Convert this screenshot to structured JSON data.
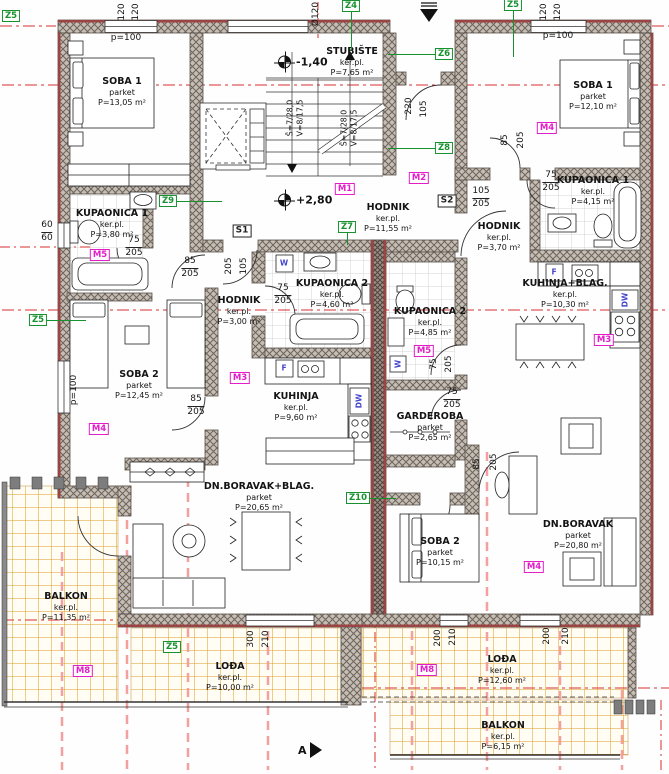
{
  "drawing": {
    "type": "architectural-floor-plan",
    "colors": {
      "wall_red": "#9c4343",
      "axis_red": "#d93030",
      "axis_pink": "#f2a0a0",
      "tag_green": "#17922f",
      "tag_magenta": "#e31ec8",
      "tile_orange": "#dc9a25",
      "appliance_blue": "#4646cc"
    }
  },
  "rooms": [
    {
      "id": "soba1-left",
      "name": "SOBA 1",
      "floor": "parket",
      "area": "P=13,05 m²",
      "x": 122,
      "y": 76
    },
    {
      "id": "kupaonica1-left",
      "name": "KUPAONICA 1",
      "floor": "ker.pl.",
      "area": "P=3,80 m²",
      "x": 112,
      "y": 208
    },
    {
      "id": "soba2-left",
      "name": "SOBA 2",
      "floor": "parket",
      "area": "P=12,45 m²",
      "x": 139,
      "y": 369
    },
    {
      "id": "hodnik-left",
      "name": "HODNIK",
      "floor": "ker.pl.",
      "area": "P=3,00 m²",
      "x": 239,
      "y": 295
    },
    {
      "id": "kupaonica2-left",
      "name": "KUPAONICA 2",
      "floor": "ker.pl.",
      "area": "P=4,60 m²",
      "x": 332,
      "y": 278
    },
    {
      "id": "kuhinja-left",
      "name": "KUHINJA",
      "floor": "ker.pl.",
      "area": "P=9,60 m²",
      "x": 296,
      "y": 391
    },
    {
      "id": "dnevni-left",
      "name": "DN.BORAVAK+BLAG.",
      "floor": "parket",
      "area": "P=20,65 m²",
      "x": 259,
      "y": 481
    },
    {
      "id": "balkon-left",
      "name": "BALKON",
      "floor": "ker.pl.",
      "area": "P=11,35 m²",
      "x": 66,
      "y": 591
    },
    {
      "id": "loda-left",
      "name": "LOĐA",
      "floor": "ker.pl.",
      "area": "P=10,00 m²",
      "x": 230,
      "y": 661
    },
    {
      "id": "stubiste",
      "name": "STUBIŠTE",
      "floor": "ker.pl.",
      "area": "P=7,65 m²",
      "x": 352,
      "y": 46
    },
    {
      "id": "hodnik-zajednicki",
      "name": "HODNIK",
      "floor": "ker.pl.",
      "area": "P=11,55 m²",
      "x": 388,
      "y": 202
    },
    {
      "id": "soba1-right",
      "name": "SOBA 1",
      "floor": "parket",
      "area": "P=12,10 m²",
      "x": 593,
      "y": 80
    },
    {
      "id": "kupaonica1-right",
      "name": "KUPAONICA 1",
      "floor": "ker.pl.",
      "area": "P=4,15 m²",
      "x": 593,
      "y": 175
    },
    {
      "id": "hodnik-right",
      "name": "HODNIK",
      "floor": "ker.pl.",
      "area": "P=3,70 m²",
      "x": 499,
      "y": 221
    },
    {
      "id": "kuhinja-blag-right",
      "name": "KUHINJA+BLAG.",
      "floor": "ker.pl.",
      "area": "P=10,30 m²",
      "x": 565,
      "y": 278
    },
    {
      "id": "kupaonica2-right",
      "name": "KUPAONICA 2",
      "floor": "ker.pl.",
      "area": "P=4,85 m²",
      "x": 430,
      "y": 306
    },
    {
      "id": "garderoba-right",
      "name": "GARDEROBA",
      "floor": "parket",
      "area": "P=2,65 m²",
      "x": 430,
      "y": 411
    },
    {
      "id": "soba2-right",
      "name": "SOBA 2",
      "floor": "parket",
      "area": "P=10,15 m²",
      "x": 440,
      "y": 536
    },
    {
      "id": "dnevni-right",
      "name": "DN.BORAVAK",
      "floor": "parket",
      "area": "P=20,80 m²",
      "x": 578,
      "y": 519
    },
    {
      "id": "loda-right",
      "name": "LOĐA",
      "floor": "ker.pl.",
      "area": "P=12,60 m²",
      "x": 502,
      "y": 654
    },
    {
      "id": "balkon-right",
      "name": "BALKON",
      "floor": "ker.pl.",
      "area": "P=6,15 m²",
      "x": 503,
      "y": 720
    }
  ],
  "green_tags": [
    {
      "label": "Z5",
      "x": 11,
      "y": 16,
      "lx": 0,
      "ly": 0
    },
    {
      "label": "Z4",
      "x": 351,
      "y": 6,
      "lx": 0,
      "ly": 38
    },
    {
      "label": "Z5",
      "x": 513,
      "y": 5,
      "lx": 0,
      "ly": 46
    },
    {
      "label": "Z6",
      "x": 444,
      "y": 54,
      "lx": -48,
      "ly": 0
    },
    {
      "label": "Z8",
      "x": 444,
      "y": 148,
      "lx": -48,
      "ly": 0
    },
    {
      "label": "Z9",
      "x": 168,
      "y": 201,
      "lx": 46,
      "ly": 0
    },
    {
      "label": "Z7",
      "x": 347,
      "y": 227,
      "lx": 0,
      "ly": 12
    },
    {
      "label": "Z5",
      "x": 38,
      "y": 320,
      "lx": 40,
      "ly": 0
    },
    {
      "label": "Z10",
      "x": 358,
      "y": 498,
      "lx": 30,
      "ly": 0
    },
    {
      "label": "Z5",
      "x": 172,
      "y": 647,
      "lx": 0,
      "ly": 0
    }
  ],
  "magenta_tags": [
    {
      "label": "M5",
      "x": 100,
      "y": 255
    },
    {
      "label": "M1",
      "x": 345,
      "y": 189
    },
    {
      "label": "M2",
      "x": 419,
      "y": 178
    },
    {
      "label": "M4",
      "x": 547,
      "y": 128
    },
    {
      "label": "M3",
      "x": 240,
      "y": 378
    },
    {
      "label": "M5",
      "x": 424,
      "y": 351
    },
    {
      "label": "M3",
      "x": 604,
      "y": 340
    },
    {
      "label": "M4",
      "x": 99,
      "y": 429
    },
    {
      "label": "M4",
      "x": 534,
      "y": 567
    },
    {
      "label": "M8",
      "x": 83,
      "y": 671
    },
    {
      "label": "M8",
      "x": 427,
      "y": 670
    }
  ],
  "s_tags": [
    {
      "label": "S1",
      "x": 242,
      "y": 231
    },
    {
      "label": "S2",
      "x": 447,
      "y": 201
    }
  ],
  "dim_pairs": [
    {
      "top": "75",
      "bottom": "205",
      "x": 134,
      "y": 236
    },
    {
      "top": "85",
      "bottom": "205",
      "x": 190,
      "y": 257
    },
    {
      "top": "85",
      "bottom": "205",
      "x": 196,
      "y": 395
    },
    {
      "top": "75",
      "bottom": "205",
      "x": 283,
      "y": 284
    },
    {
      "top": "105",
      "bottom": "205",
      "x": 481,
      "y": 187
    },
    {
      "top": "75",
      "bottom": "205",
      "x": 551,
      "y": 171
    },
    {
      "top": "75",
      "bottom": "205",
      "x": 452,
      "y": 388
    },
    {
      "top": "60",
      "bottom": "60",
      "x": 47,
      "y": 221
    }
  ],
  "dim_rot": [
    {
      "t": "120",
      "x": 122,
      "y": 12
    },
    {
      "t": "120",
      "x": 136,
      "y": 12
    },
    {
      "t": "Ø120",
      "x": 316,
      "y": 14
    },
    {
      "t": "120",
      "x": 544,
      "y": 12
    },
    {
      "t": "120",
      "x": 558,
      "y": 12
    },
    {
      "t": "205",
      "x": 229,
      "y": 266
    },
    {
      "t": "105",
      "x": 244,
      "y": 266
    },
    {
      "t": "220",
      "x": 409,
      "y": 106
    },
    {
      "t": "105",
      "x": 424,
      "y": 109
    },
    {
      "t": "85",
      "x": 505,
      "y": 140
    },
    {
      "t": "205",
      "x": 521,
      "y": 140
    },
    {
      "t": "75",
      "x": 434,
      "y": 364
    },
    {
      "t": "205",
      "x": 449,
      "y": 364
    },
    {
      "t": "85",
      "x": 477,
      "y": 464
    },
    {
      "t": "205",
      "x": 494,
      "y": 462
    },
    {
      "t": "300",
      "x": 251,
      "y": 639
    },
    {
      "t": "210",
      "x": 266,
      "y": 639
    },
    {
      "t": "200",
      "x": 438,
      "y": 638
    },
    {
      "t": "210",
      "x": 453,
      "y": 637
    },
    {
      "t": "200",
      "x": 547,
      "y": 636
    },
    {
      "t": "210",
      "x": 566,
      "y": 636
    },
    {
      "t": "p=100",
      "x": 74,
      "y": 390
    }
  ],
  "window_notes": [
    {
      "t": "p=100",
      "x": 126,
      "y": 38
    },
    {
      "t": "p=100",
      "x": 558,
      "y": 36
    }
  ],
  "stair_texts": [
    {
      "t": "Š=7/28,0",
      "x": 290,
      "y": 118
    },
    {
      "t": "V=8/17,5",
      "x": 300,
      "y": 118
    },
    {
      "t": "Š=7/28,0",
      "x": 344,
      "y": 128
    },
    {
      "t": "V=8/17,5",
      "x": 354,
      "y": 128
    }
  ],
  "levels": [
    {
      "t": "-1,40",
      "x": 278,
      "y": 62
    },
    {
      "t": "+2,80",
      "x": 278,
      "y": 200
    }
  ],
  "appliance_tags": [
    {
      "t": "W",
      "x": 284,
      "y": 263,
      "rot": 0
    },
    {
      "t": "F",
      "x": 284,
      "y": 368,
      "rot": 0
    },
    {
      "t": "DW",
      "x": 359,
      "y": 401,
      "rot": -90
    },
    {
      "t": "W",
      "x": 398,
      "y": 364,
      "rot": -90
    },
    {
      "t": "F",
      "x": 554,
      "y": 272,
      "rot": 0
    },
    {
      "t": "DW",
      "x": 625,
      "y": 300,
      "rot": -90
    }
  ],
  "section_marker": {
    "label": "A",
    "x": 298,
    "y": 742
  },
  "entry_arrow": {
    "name": "entry-arrow"
  }
}
